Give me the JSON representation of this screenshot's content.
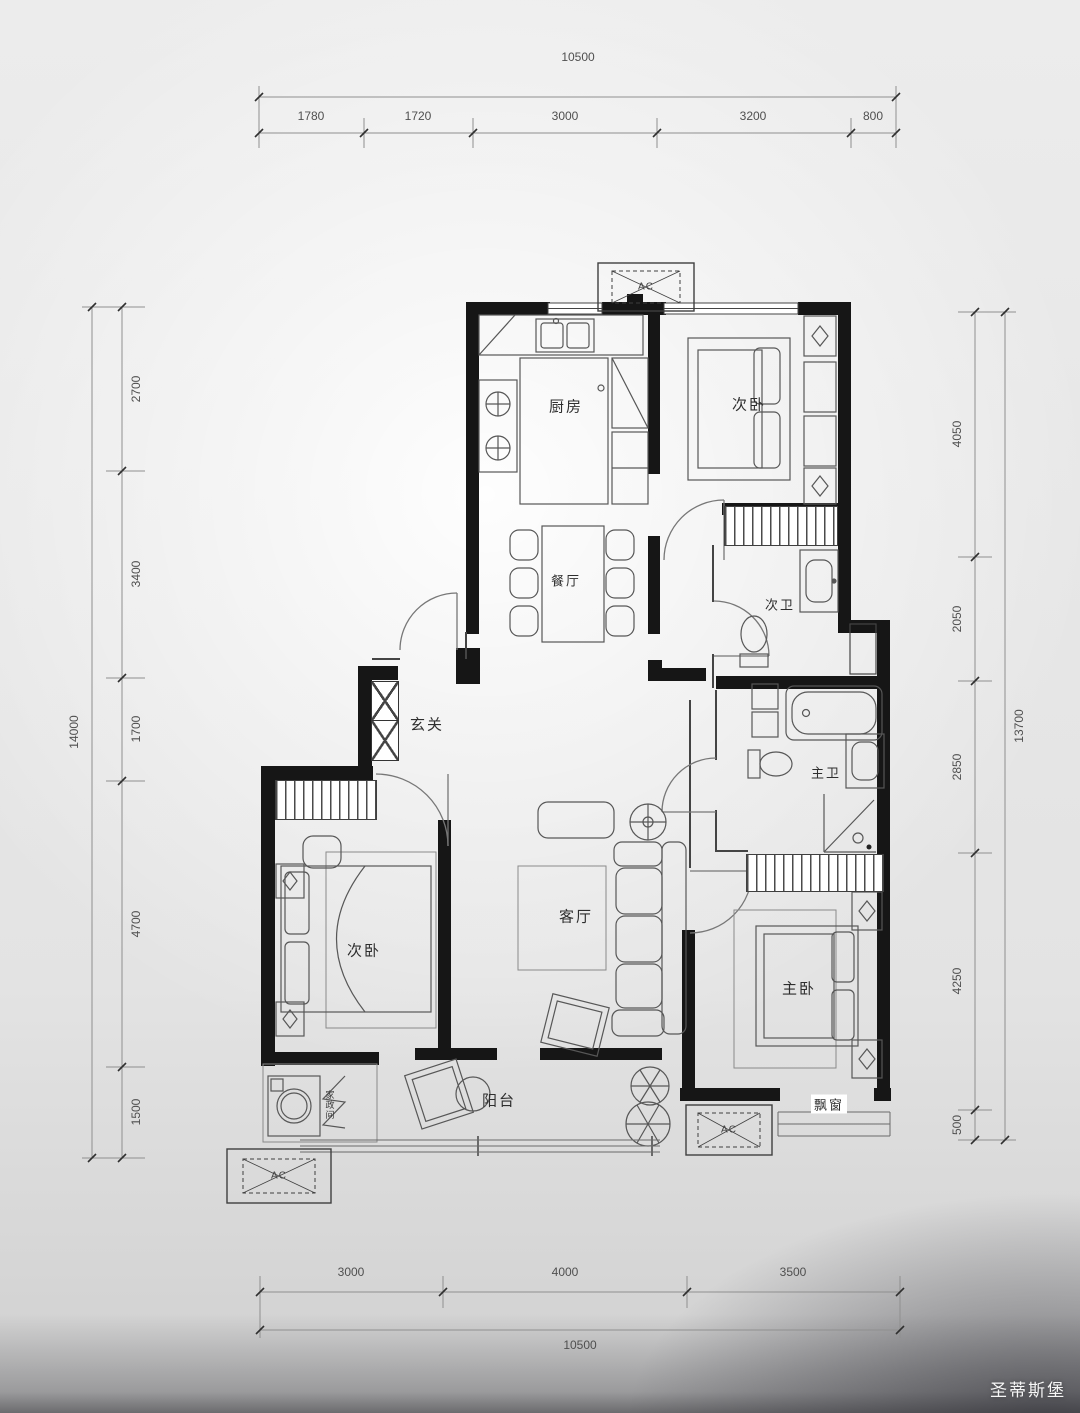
{
  "dimensions": {
    "top": {
      "total": "10500",
      "segments": [
        "1780",
        "1720",
        "3000",
        "3200",
        "800"
      ]
    },
    "bottom": {
      "total": "10500",
      "segments": [
        "3000",
        "4000",
        "3500"
      ]
    },
    "left": {
      "total": "14000",
      "segments": [
        "2700",
        "3400",
        "1700",
        "4700",
        "1500"
      ]
    },
    "right": {
      "total": "13700",
      "segments": [
        "4050",
        "2050",
        "2850",
        "4250",
        "500"
      ]
    }
  },
  "rooms": {
    "kitchen": "厨房",
    "bedroom_top": "次卧",
    "dining": "餐厅",
    "bath2": "次卫",
    "foyer": "玄关",
    "living": "客厅",
    "bedroom_left": "次卧",
    "master": "主卧",
    "master_bath": "主卫",
    "balcony": "阳台",
    "bay_window": "飘窗",
    "utility": "家政间"
  },
  "labels": {
    "ac": "AC"
  },
  "watermark": "圣蒂斯堡"
}
